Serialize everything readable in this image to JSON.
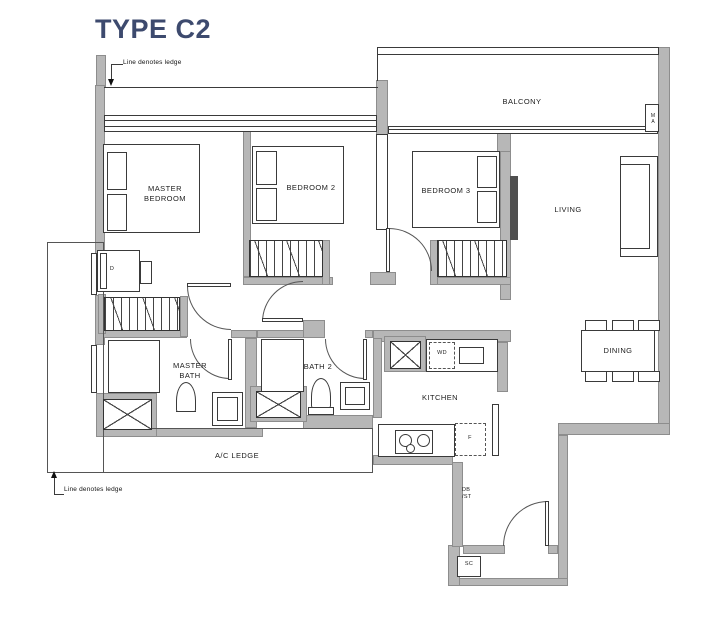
{
  "title": "TYPE C2",
  "notes": {
    "top": "Line denotes ledge",
    "bottom": "Line denotes ledge"
  },
  "rooms": {
    "balcony": "BALCONY",
    "master_bedroom": "MASTER\nBEDROOM",
    "bedroom2": "BEDROOM 2",
    "bedroom3": "BEDROOM 3",
    "living": "LIVING",
    "dining": "DINING",
    "kitchen": "KITCHEN",
    "master_bath": "MASTER\nBATH",
    "bath2": "BATH 2",
    "ac_ledge": "A/C LEDGE"
  },
  "markers": {
    "dresser": "D",
    "washer_dryer": "WD",
    "fridge": "F",
    "db_st": "DB\n/ST",
    "shoe_cabinet": "SC",
    "balcony_tag": "MA"
  },
  "colors": {
    "wall": "#b7b7b7",
    "line": "#3a3a3a",
    "title": "#3d4a6e",
    "label": "#1d1d1d"
  }
}
